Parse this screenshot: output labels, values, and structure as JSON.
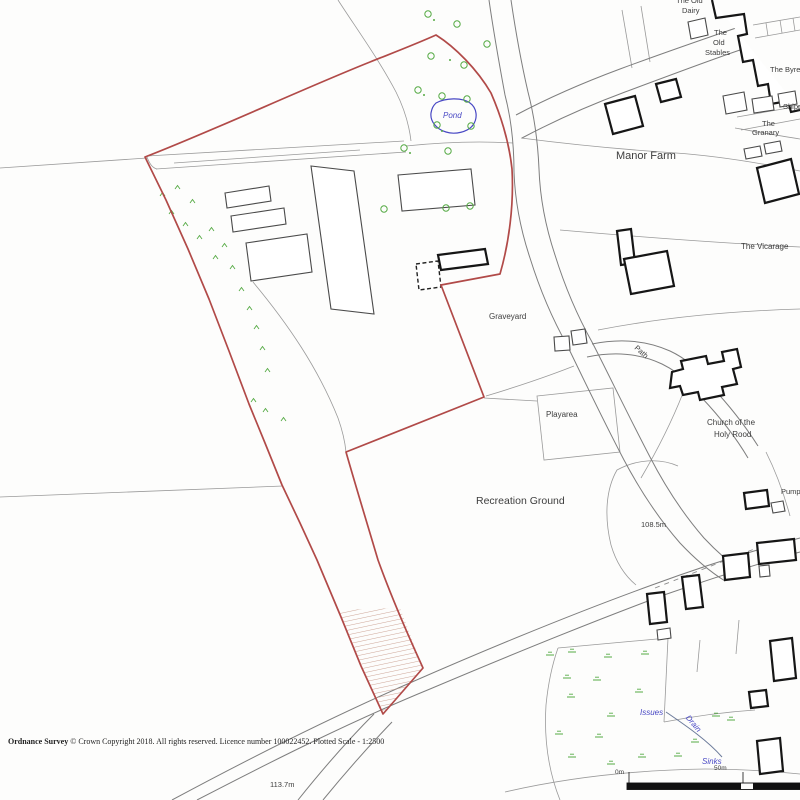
{
  "labels": {
    "the_old": "The Old",
    "dairy": "Dairy",
    "stables_the": "The",
    "stables_old": "Old",
    "stables": "Stables",
    "the_byre": "The Byre",
    "shippon": "Shippon",
    "granary_the": "The",
    "granary": "Granary",
    "manor_farm": "Manor Farm",
    "the_vicarage": "The Vicarage",
    "pond": "Pond",
    "graveyard": "Graveyard",
    "playarea": "Playarea",
    "path": "Path",
    "church_line1": "Church of the",
    "church_line2": "Holy Rood",
    "recreation_ground": "Recreation Ground",
    "spot_height_recreation": "108.5m",
    "pump": "Pump",
    "issues": "Issues",
    "drain": "Drain",
    "sinks": "Sinks",
    "spot_height_road": "113.7m"
  },
  "scalebar": {
    "start": "0m",
    "end": "50m"
  },
  "footer": {
    "attribution_bold": "Ordnance Survey",
    "attribution_rest": " © Crown Copyright 2018. All rights reserved. Licence number 100022452. Plotted Scale - 1:2500"
  },
  "colors": {
    "boundary_red": "#b14a48",
    "water_blue": "#4848c4",
    "vegetation_green": "#55aa44",
    "hatch_red": "#c89b8b"
  }
}
